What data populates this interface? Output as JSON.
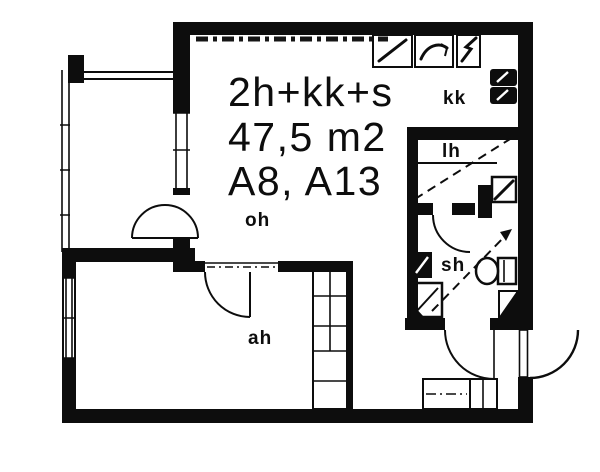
{
  "plan": {
    "colors": {
      "ink": "#0d0d0d",
      "background": "#ffffff"
    },
    "title": {
      "line1": "2h+kk+s",
      "line2": "47,5 m2",
      "line3": "A8, A13"
    },
    "room_labels": {
      "living_room": "oh",
      "bedroom": "ah",
      "kitchenette": "kk",
      "sauna": "lh",
      "bathroom": "sh"
    },
    "fixture_icons": [
      "stove-icon",
      "dishwasher-icon",
      "fridge-icon",
      "tall-cabinet-icon",
      "sauna-stove-icon",
      "washbasin-icon",
      "shower-icon",
      "toilet-icon",
      "wardrobe-icon",
      "closet-grid-icon",
      "door-swing-arc-icon",
      "window-icon",
      "slope-arrow-icon"
    ]
  }
}
